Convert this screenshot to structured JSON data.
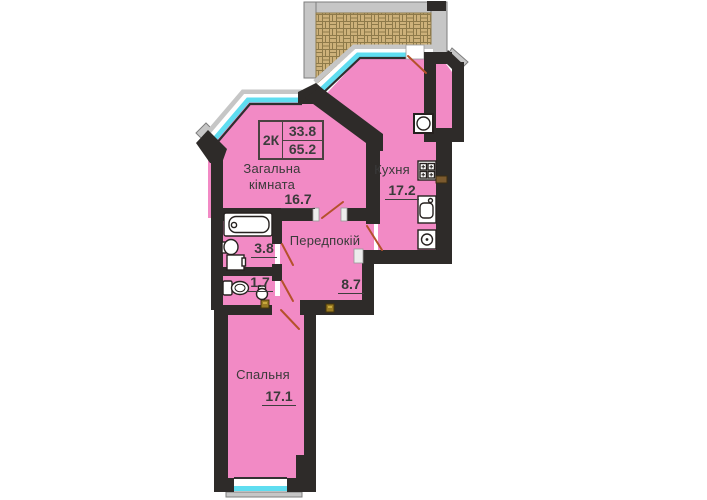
{
  "plan": {
    "summary": {
      "type_label": "2К",
      "value_top": "33.8",
      "value_bottom": "65.2"
    },
    "rooms": {
      "living": {
        "name": "Загальна кімната",
        "area": "16.7"
      },
      "kitchen": {
        "name": "Кухня",
        "area": "17.2"
      },
      "hall": {
        "name": "Передпокій",
        "area": "8.7"
      },
      "bathroom": {
        "area": "3.8"
      },
      "wc": {
        "area": "1.7"
      },
      "bedroom": {
        "name": "Спальня",
        "area": "17.1"
      }
    },
    "colors": {
      "floor": "#F28AC5",
      "wall": "#2E2B29",
      "window": "#5FDDF0",
      "door": "#B5512B",
      "sill": "#C6C6C6",
      "balcony_tile": "#CDB17A"
    }
  }
}
